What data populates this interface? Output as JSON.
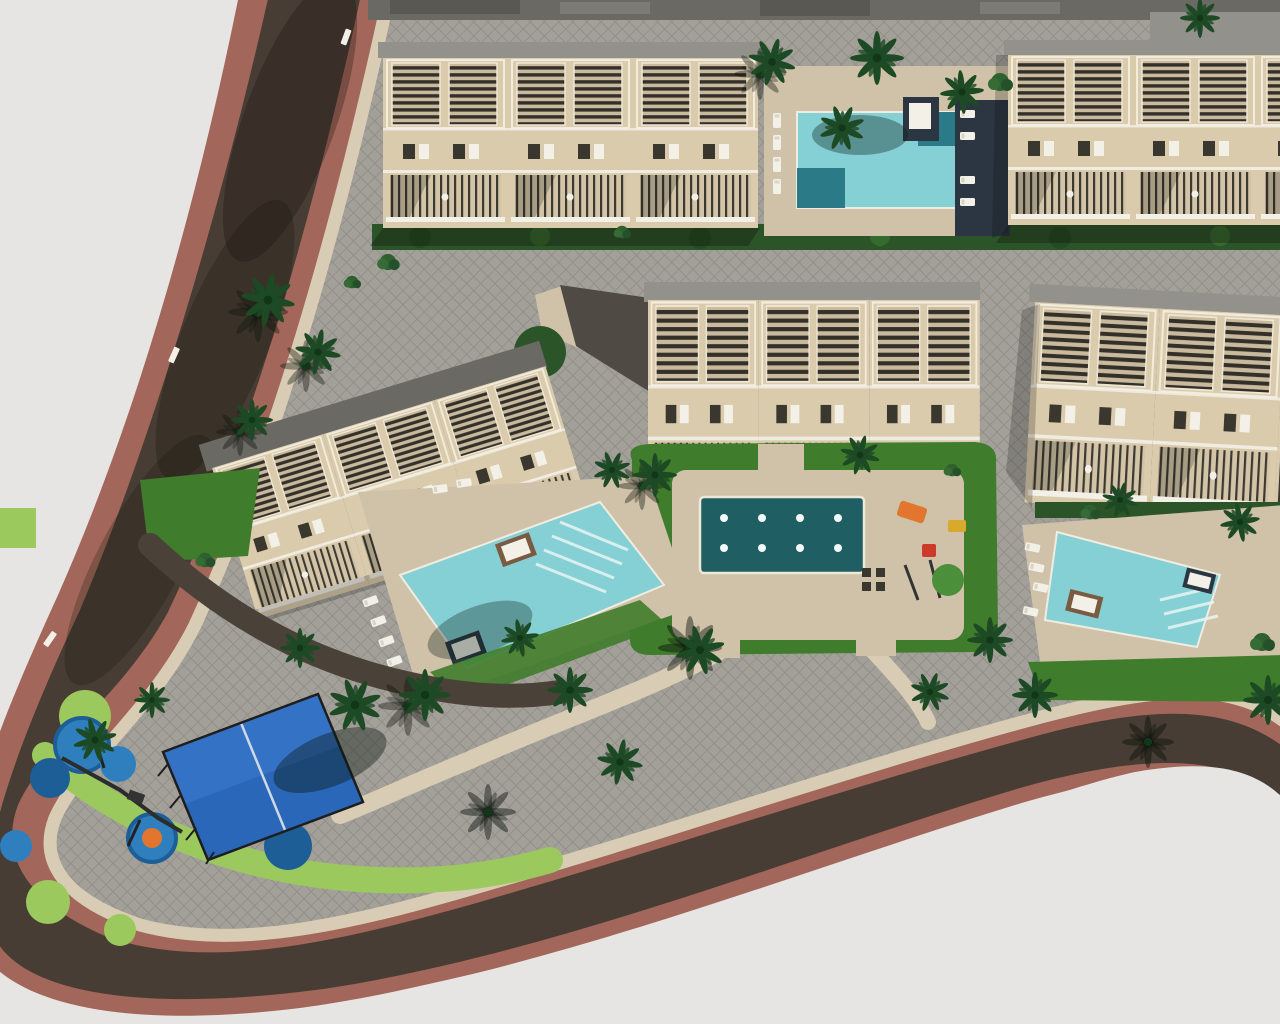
{
  "scene": {
    "type": "aerial-3d-architectural-render",
    "description": "Top-down 3D rendering of a new-build residential complex: five beige townhouse blocks with louvered roof terraces, three large turquoise swimming pools with sun loungers, a central plaza with an ornamental fountain pool, a fenced blue multi-sport court, a children's playground with blue rubber pads, palm trees and lawns, all wrapped by a curving asphalt road with terracotta sidewalks on a light gray ground",
    "counts": {
      "townhouse_blocks": 5,
      "swimming_pools": 3,
      "fountain_jets": 8,
      "sport_courts": 1,
      "play_pads": 8,
      "palm_trees": 26
    }
  },
  "labels": {
    "stage": "Aerial render of residential complex site plan",
    "road": "Perimeter access road with terracotta sidewalks",
    "site": "Paved residential site area",
    "building_top_left": "Townhouse row - top left",
    "building_top_right": "Townhouse row - top right",
    "building_center": "Townhouse row - center",
    "building_right": "Townhouse row - right",
    "building_left": "Townhouse row - left (rotated)",
    "pool_top": "Community pool - top",
    "pool_left": "Community pool - center left",
    "pool_right": "Community pool - right",
    "plaza": "Central plaza with ornamental fountain pool",
    "court": "Fenced multi-sport court",
    "playground": "Children's playground with rubber pads",
    "vegetation": "Palm trees, hedges and lawns"
  },
  "colors": {
    "background": "#e6e5e3",
    "road-asphalt": "#473d34",
    "sidewalk-terracotta": "#a2675a",
    "path-beige": "#d9ccb4",
    "paver-gray": "#a3a09a",
    "paver-line": "#918e88",
    "deck-beige": "#cfc2a9",
    "building-beige": "#dbcbad",
    "roof-gray": "#93918c",
    "wall-dark-gray": "#6b6964",
    "louver-dark": "#37342e",
    "hedge-green": "#2c5429",
    "lawn-green": "#3f7c2b",
    "lawn-light": "#9cc95d",
    "pool-turquoise": "#85d0d5",
    "pool-step-teal": "#2a7a88",
    "fountain-pool-teal": "#1f5f63",
    "sport-court-blue": "#2a67b8",
    "play-pad-blue": "#2f7fbe",
    "play-pad-ring": "#1d5e96",
    "play-orange": "#e3762e",
    "deck-navy": "#2b3642",
    "palm-green": "#1d4a24",
    "lounger-white": "#f3f0e7"
  }
}
